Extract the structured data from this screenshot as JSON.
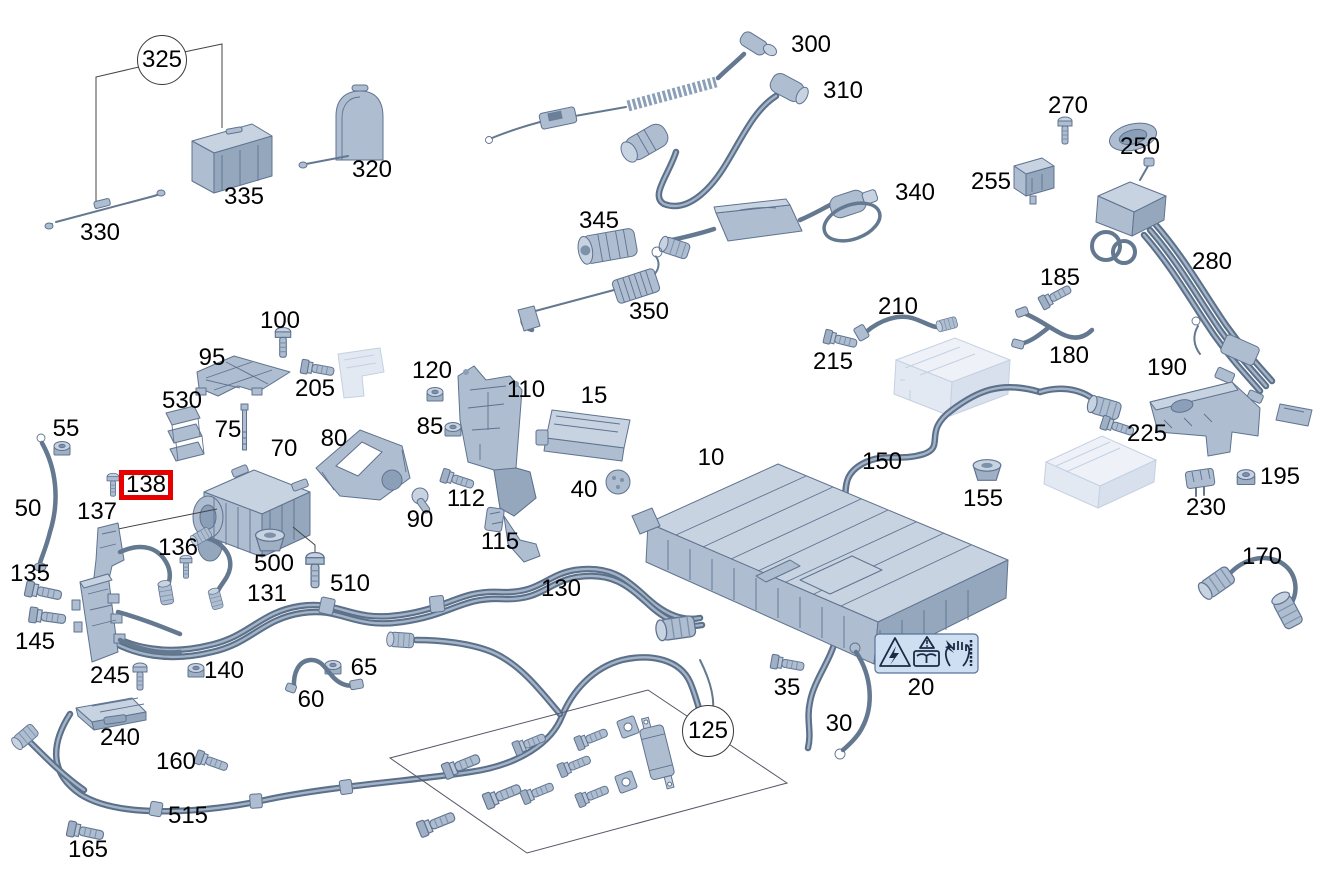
{
  "diagram": {
    "type": "exploded-parts-diagram",
    "subject": "Hybrid high-voltage battery, charging cables and wiring harness",
    "background_color": "#ffffff",
    "part_fill_color": "#aebdd0",
    "part_outline_color": "#5f7390",
    "ghost_part_color": "#e2e9f2",
    "label_color": "#000000",
    "highlight_box_color": "#e60000"
  },
  "highlight": {
    "part": "138"
  },
  "callouts": {
    "group_top_left": "325",
    "hardware_kit": "125"
  },
  "warning_label": {
    "number": "20",
    "icons": [
      "high-voltage-warning-icon",
      "read-operating-instructions-icon",
      "electric-shock-hand-icon"
    ]
  },
  "labels": {
    "p10": "10",
    "p15": "15",
    "p20": "20",
    "p30": "30",
    "p35": "35",
    "p40": "40",
    "p50": "50",
    "p55": "55",
    "p60": "60",
    "p65": "65",
    "p70": "70",
    "p75": "75",
    "p80": "80",
    "p85": "85",
    "p90": "90",
    "p95": "95",
    "p100": "100",
    "p110": "110",
    "p112": "112",
    "p115": "115",
    "p120": "120",
    "p130": "130",
    "p131": "131",
    "p135": "135",
    "p136": "136",
    "p137": "137",
    "p140": "140",
    "p145": "145",
    "p150": "150",
    "p155": "155",
    "p160": "160",
    "p165": "165",
    "p170": "170",
    "p180": "180",
    "p185": "185",
    "p190": "190",
    "p195": "195",
    "p205": "205",
    "p210": "210",
    "p215": "215",
    "p225": "225",
    "p230": "230",
    "p240": "240",
    "p245": "245",
    "p250": "250",
    "p255": "255",
    "p270": "270",
    "p280": "280",
    "p300": "300",
    "p310": "310",
    "p320": "320",
    "p330": "330",
    "p335": "335",
    "p340": "340",
    "p345": "345",
    "p350": "350",
    "p500": "500",
    "p510": "510",
    "p515": "515",
    "p530": "530"
  }
}
